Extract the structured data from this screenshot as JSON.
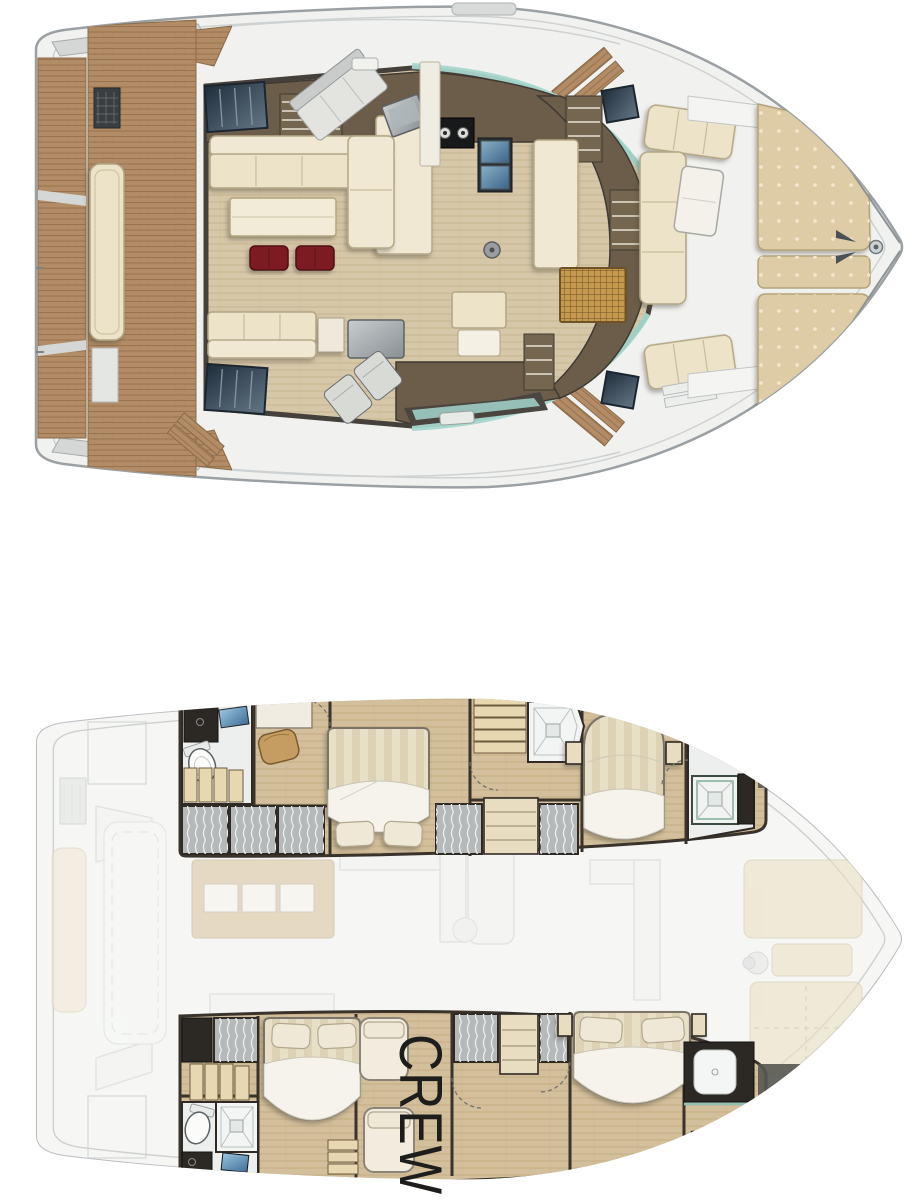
{
  "image": {
    "kind": "catamaran-yacht-floorplan",
    "views": [
      {
        "id": "main-deck-plan",
        "areas": [
          "aft-swim-platform",
          "aft-cockpit",
          "salon",
          "galley",
          "helm-station",
          "forward-cockpit",
          "bow-sunpads"
        ]
      },
      {
        "id": "lower-deck-plan",
        "areas": [
          "port-aft-cabin",
          "port-bathroom",
          "port-forward-cabin",
          "starboard-aft-cabin",
          "crew-quarters",
          "starboard-forward-cabin",
          "ghost-main-deck-overlay"
        ]
      }
    ]
  },
  "labels": {
    "crew": "CREW"
  },
  "palette": {
    "background": "#ffffff",
    "hull_fill": "#f1f2f0",
    "hull_stroke": "#9aa0a3",
    "teak": "#b18c66",
    "teak_line": "#9a734e",
    "cabinetry_dark": "#6b5d49",
    "salon_floor": "#d6c7a8",
    "cabin_floor": "#d3bf9c",
    "upholstery_cream": "#ece3c9",
    "sunpad_beige": "#decca6",
    "stool_red": "#7c1d20",
    "window_navy": "#22303e",
    "windshield_teal": "#a6d7cd",
    "wall_dark": "#3a332b",
    "locker_gray": "#b5b9ba",
    "bed_cream": "#efe8d6",
    "mirror_blue": "#5d88ad",
    "ghost_gray": "#d6d9d8",
    "crew_text": "#1d1d1b"
  }
}
